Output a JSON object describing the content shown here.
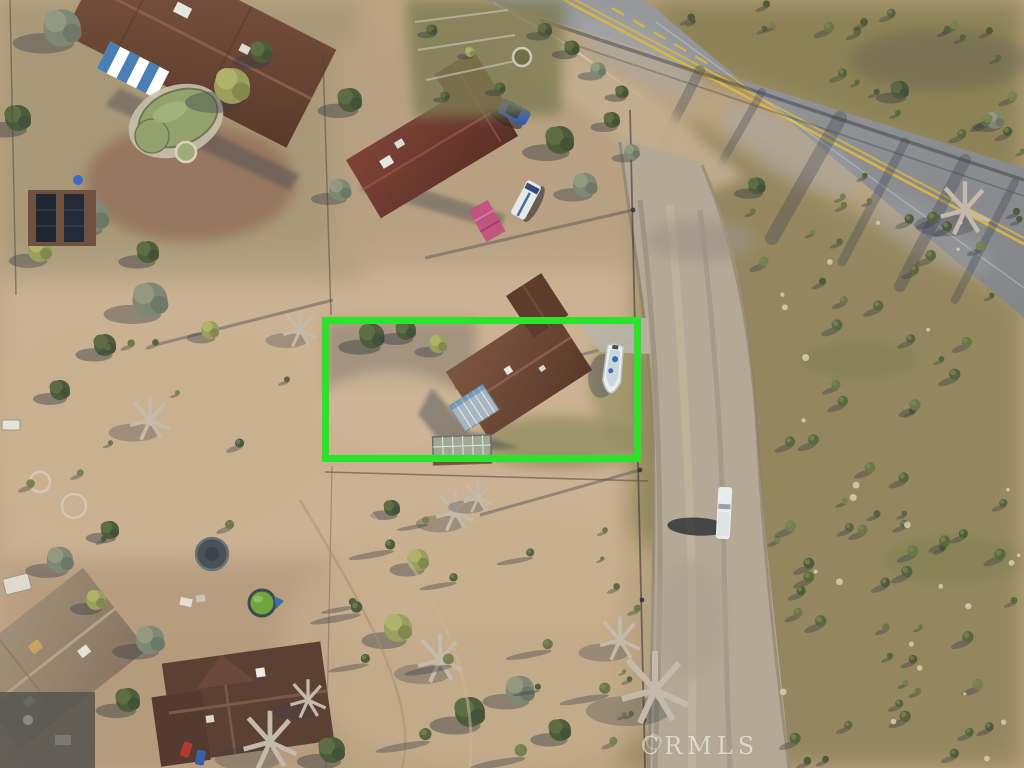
{
  "scene": {
    "type": "aerial-drone-photo",
    "description": "Overhead aerial drone photo of a desert residential neighborhood. A bright green rectangle highlights the subject lot containing a brown cross-gable roofed house, a gray metal roof section and a white boat. A paved two-lane highway with a double yellow line crosses the upper right corner, and a graded dirt road with a white pickup truck runs down the right side past olive scrubland. Neighboring homes include a house with a kidney-shaped pool (top left), a maroon-roof house with a blue car, white van and pink tarp (top middle), a shed with solar panels (left), and two large brown-roof homes with a round green pool and a trampoline (bottom left).",
    "watermark": {
      "text": "CRMLS",
      "color": "#FFFFFF"
    },
    "highlight_box": {
      "x": 322,
      "y": 317,
      "width": 319,
      "height": 145,
      "color": "#2BE32B",
      "stroke_width": 7
    },
    "palette": {
      "sand": "#BCA482",
      "sand_light": "#CFB795",
      "scrub": "#94875E",
      "asphalt": "#8F9193",
      "road_stripe_yellow": "#D9B544",
      "dirt_road": "#B5A896",
      "roof_brown": "#6F4A38",
      "roof_maroon": "#7A4136",
      "roof_dark_brown": "#5C4034",
      "pool_green": "#95A470",
      "shadow": "#3F4450",
      "highlight_green": "#2BE32B"
    }
  }
}
